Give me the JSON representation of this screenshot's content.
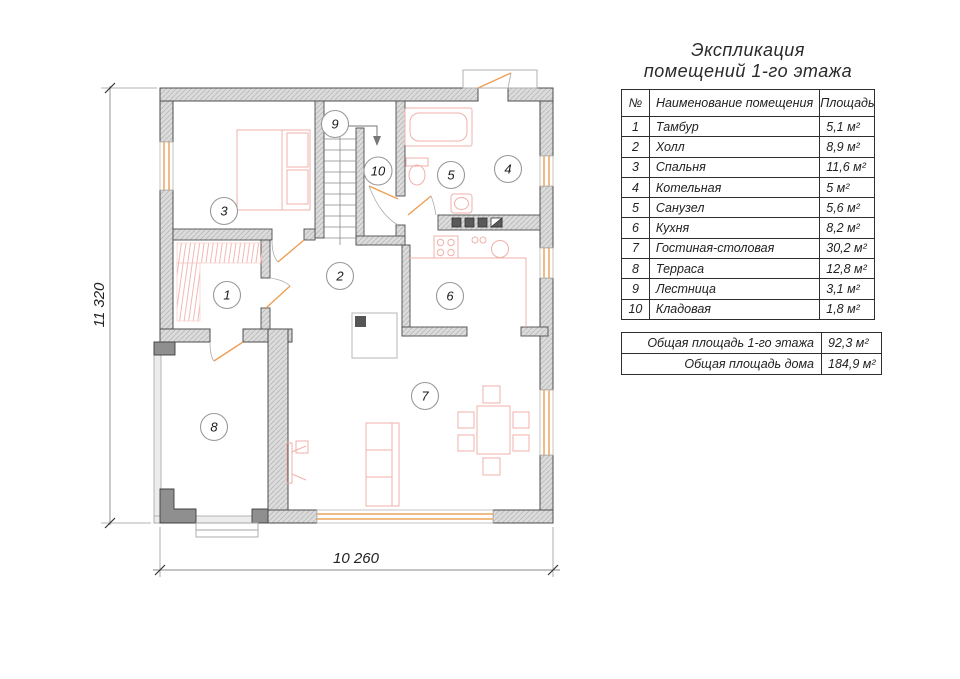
{
  "title": {
    "line1": "Экспликация",
    "line2": "помещений 1-го этажа"
  },
  "table": {
    "headers": {
      "no": "№",
      "name": "Наименование помещения",
      "area": "Площадь"
    },
    "rows": [
      {
        "no": "1",
        "name": "Тамбур",
        "area": "5,1 м²"
      },
      {
        "no": "2",
        "name": "Холл",
        "area": "8,9 м²"
      },
      {
        "no": "3",
        "name": "Спальня",
        "area": "11,6 м²"
      },
      {
        "no": "4",
        "name": "Котельная",
        "area": "5 м²"
      },
      {
        "no": "5",
        "name": "Санузел",
        "area": "5,6 м²"
      },
      {
        "no": "6",
        "name": "Кухня",
        "area": "8,2 м²"
      },
      {
        "no": "7",
        "name": "Гостиная-столовая",
        "area": "30,2 м²"
      },
      {
        "no": "8",
        "name": "Терраса",
        "area": "12,8 м²"
      },
      {
        "no": "9",
        "name": "Лестница",
        "area": "3,1 м²"
      },
      {
        "no": "10",
        "name": "Кладовая",
        "area": "1,8 м²"
      }
    ],
    "summary": [
      {
        "label": "Общая площадь 1-го этажа",
        "value": "92,3 м²"
      },
      {
        "label": "Общая площадь дома",
        "value": "184,9 м²"
      }
    ]
  },
  "plan": {
    "room_labels": [
      "1",
      "2",
      "3",
      "4",
      "5",
      "6",
      "7",
      "8",
      "9",
      "10"
    ],
    "dim_height": "11 320",
    "dim_width": "10 260",
    "colors": {
      "wall_fill": "#dcdcdc",
      "wall_edge": "#4d4d4d",
      "window_accent": "#eda45c",
      "door_accent": "#ee9f55",
      "furniture_pink": "#f0b0aa",
      "thin_gray": "#a5a5a5"
    }
  }
}
